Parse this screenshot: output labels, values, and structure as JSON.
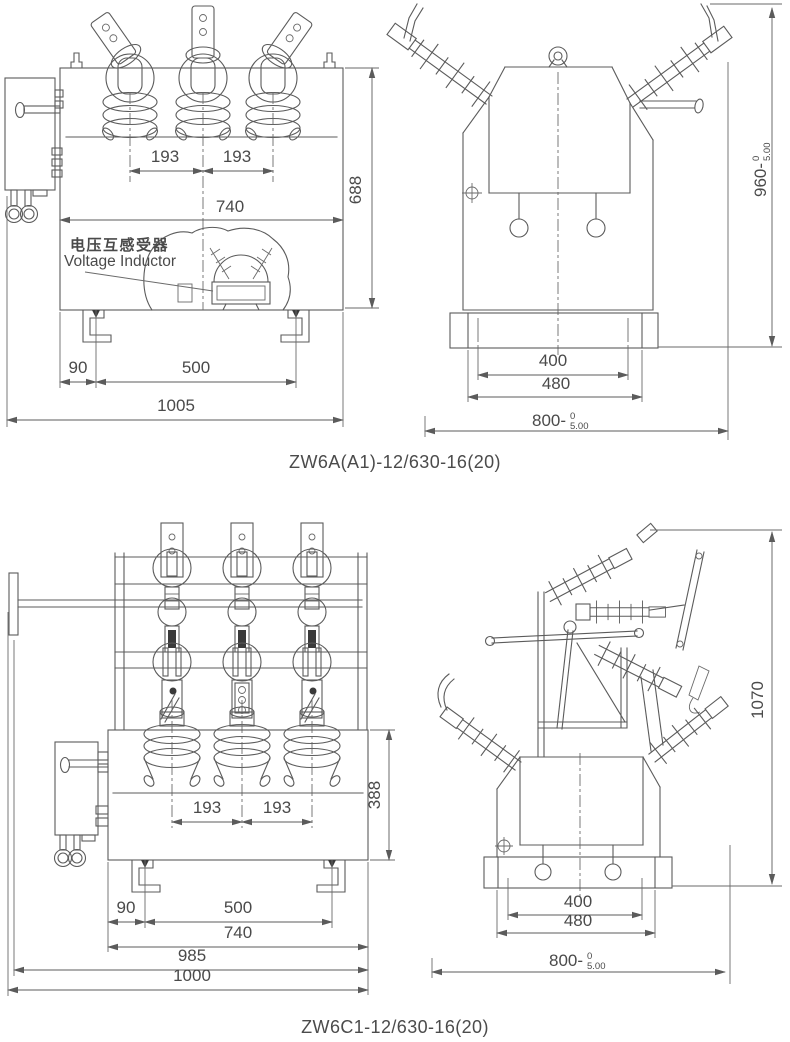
{
  "page": {
    "background": "#ffffff",
    "line_color": "#5b5b5b",
    "text_color": "#4a4a4a"
  },
  "figures": [
    {
      "id": "zw6a",
      "caption": "ZW6A(A1)-12/630-16(20)",
      "front_view": {
        "callout": {
          "cn": "电压互感受器",
          "en": "Voltage Inductor"
        },
        "dims": {
          "pitch_left": "193",
          "pitch_right": "193",
          "body_width": "740",
          "body_height": "688",
          "foot_offset": "90",
          "foot_pitch": "500",
          "overall_width": "1005"
        }
      },
      "side_view": {
        "dims": {
          "height": "960-",
          "height_tol_upper": "0",
          "height_tol_lower": "5.00",
          "slot_pitch": "400",
          "base_width": "480",
          "depth": "800-",
          "depth_tol_upper": "0",
          "depth_tol_lower": "5.00"
        }
      }
    },
    {
      "id": "zw6c1",
      "caption": "ZW6C1-12/630-16(20)",
      "front_view": {
        "dims": {
          "pitch_left": "193",
          "pitch_right": "193",
          "tank_height": "388",
          "foot_offset": "90",
          "foot_pitch": "500",
          "body_width": "740",
          "frame_width": "985",
          "overall_width": "1000"
        }
      },
      "side_view": {
        "dims": {
          "height": "1070",
          "slot_pitch": "400",
          "base_width": "480",
          "depth": "800-",
          "depth_tol_upper": "0",
          "depth_tol_lower": "5.00"
        }
      }
    }
  ]
}
